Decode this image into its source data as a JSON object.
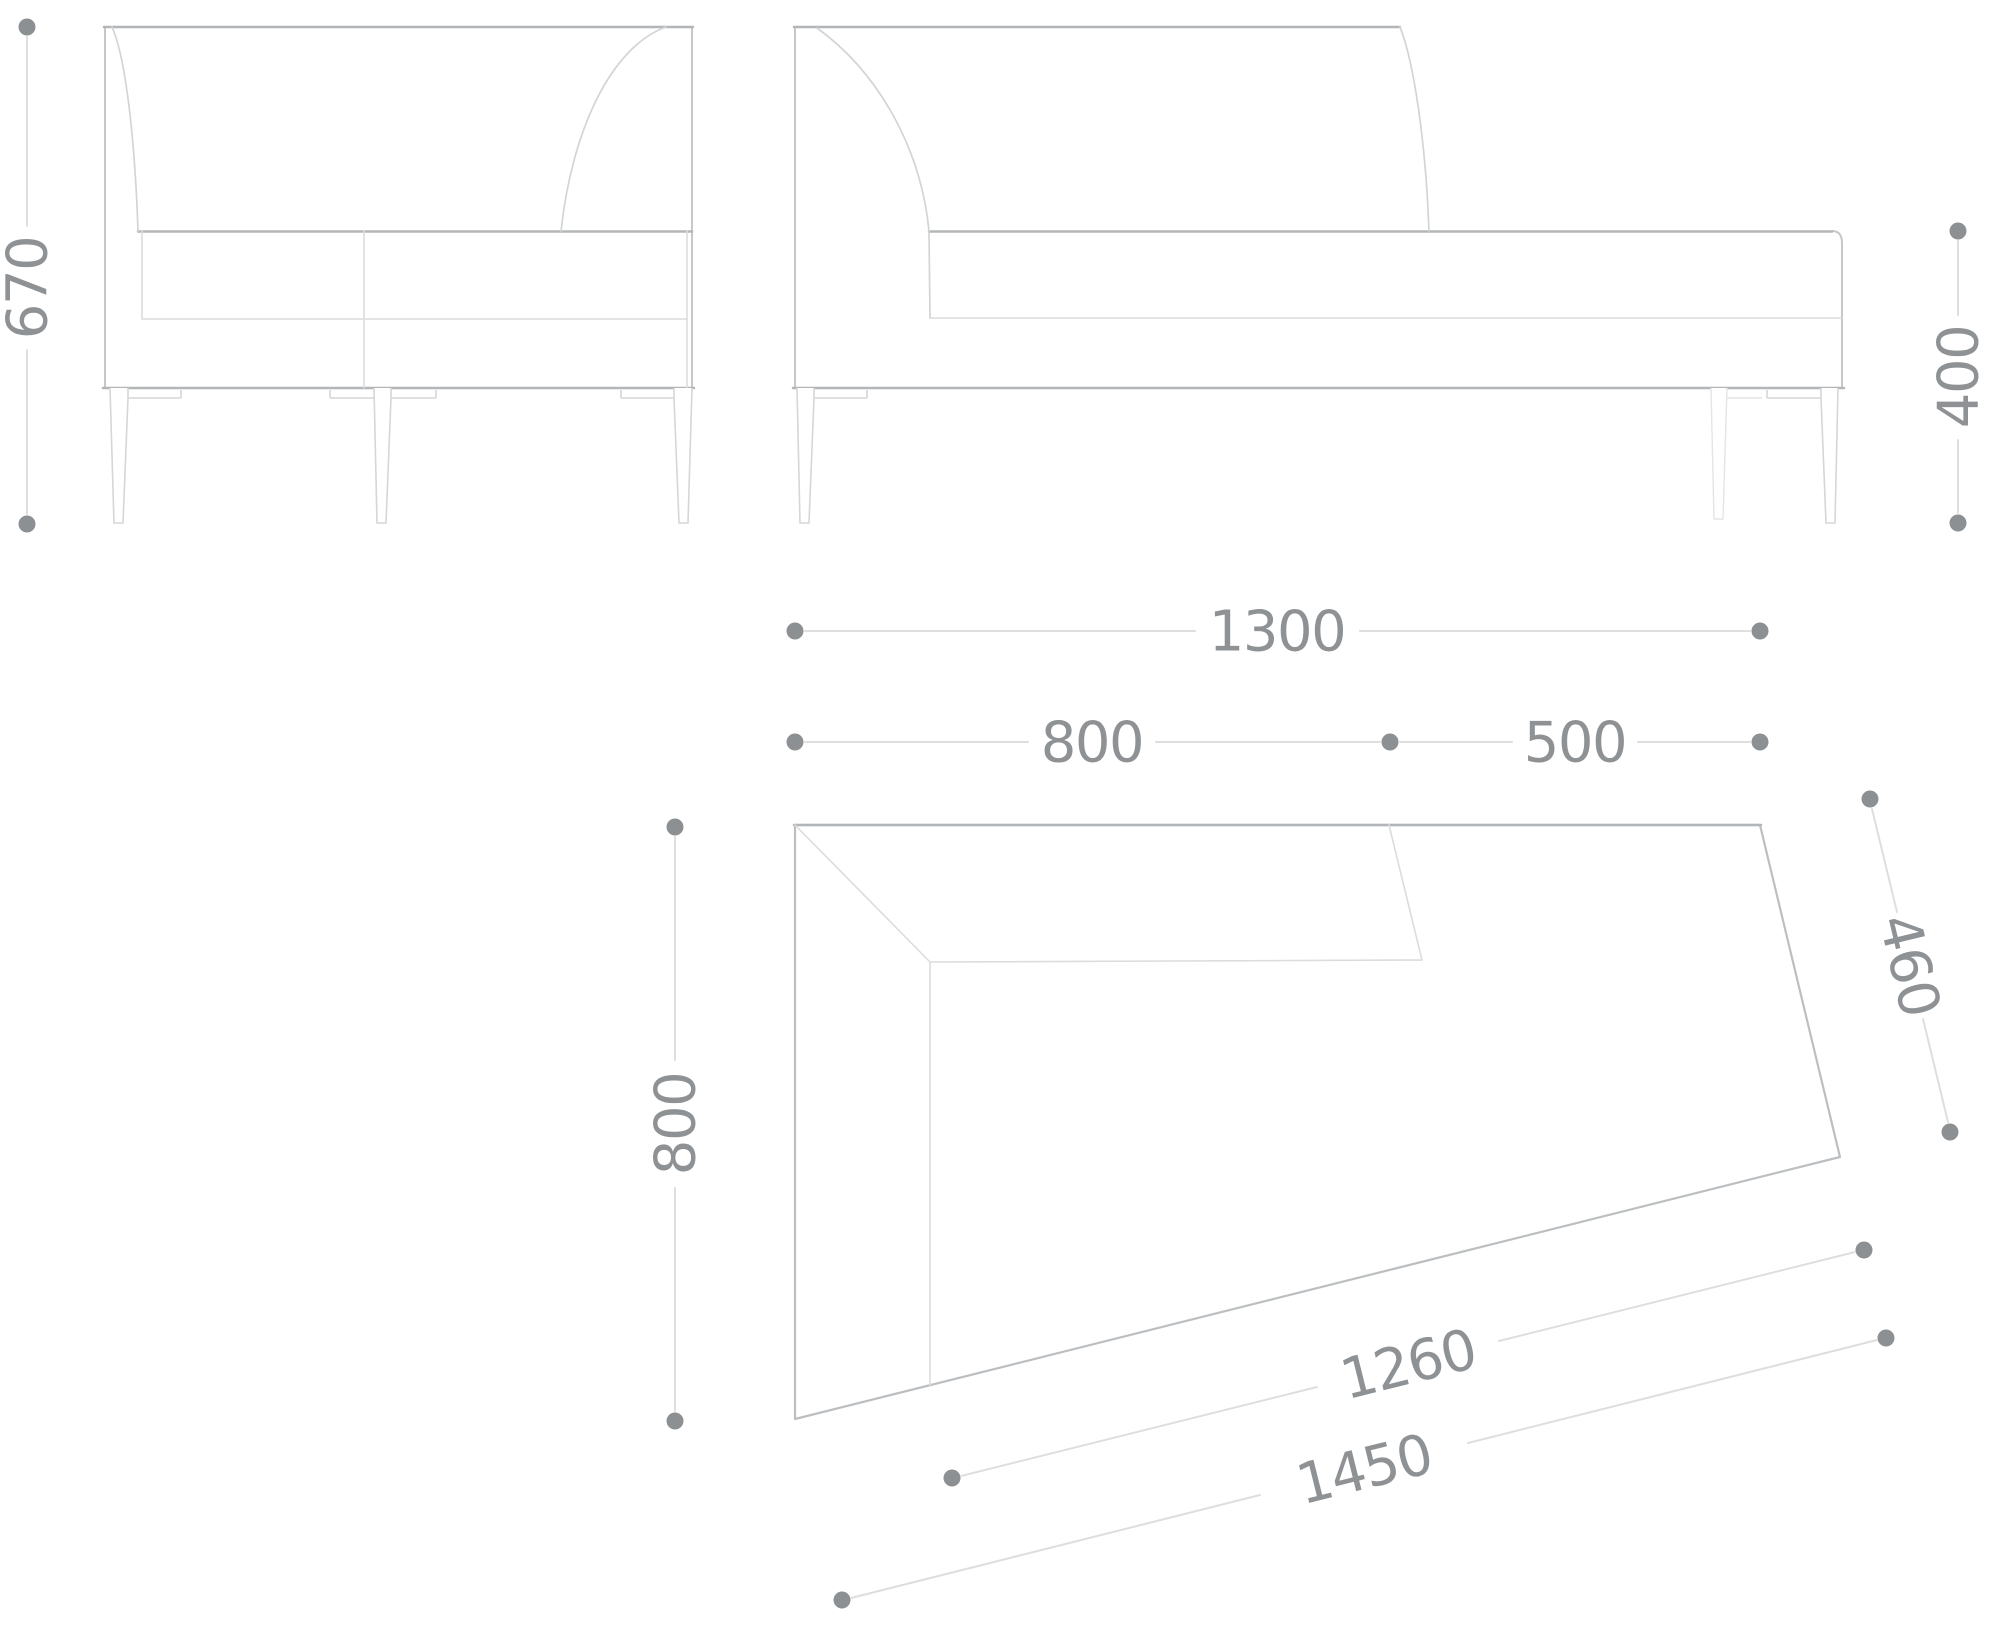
{
  "drawing": {
    "description": "Furniture technical drawing of a corner chaise sofa module shown in three orthographic line views with dimension annotations",
    "units": "mm",
    "colors": {
      "background": "#ffffff",
      "outline": "#b3b6b8",
      "detail_line": "#d8dadb",
      "dimension_line": "#dedede",
      "dimension_dot": "#8d9093",
      "dimension_text": "#8f9294"
    },
    "views": {
      "side_elevation": {
        "dims": {
          "overall_height": "670"
        }
      },
      "front_elevation": {
        "dims": {
          "seat_height": "400"
        }
      },
      "plan": {
        "dims": {
          "overall_width": "1300",
          "backrest_width": "800",
          "open_width": "500",
          "depth": "800",
          "right_edge": "460",
          "seat_front": "1260",
          "front_edge": "1450"
        }
      }
    }
  }
}
